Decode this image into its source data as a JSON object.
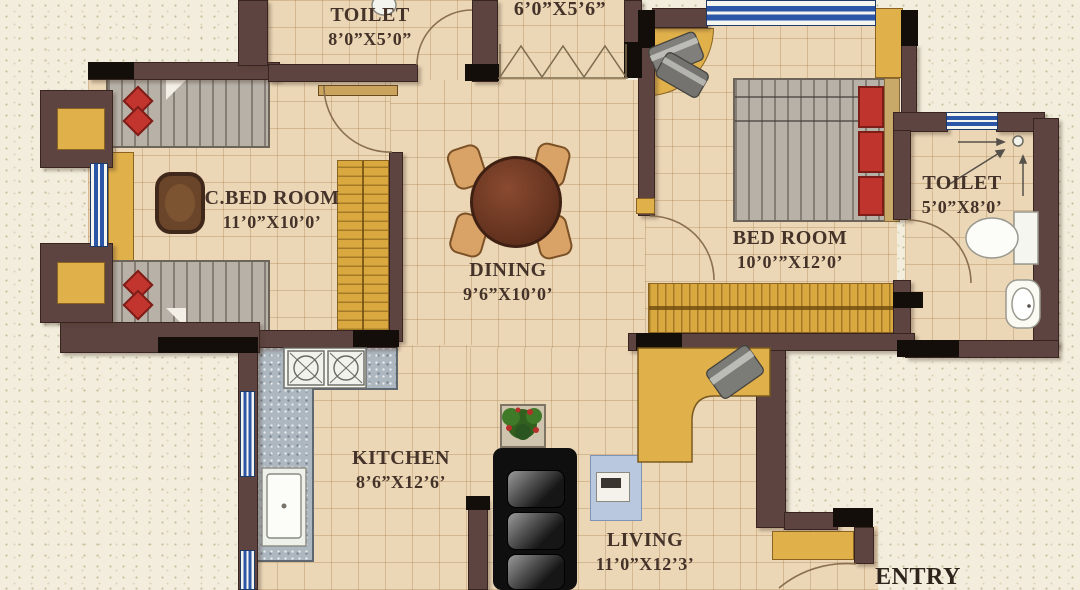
{
  "rooms": {
    "toilet_top": {
      "name": "TOILET",
      "dims": "8’0”X5’0”"
    },
    "dress": {
      "dims": "6’0”X5’6”"
    },
    "c_bed_room": {
      "name": "C.BED ROOM",
      "dims": "11’0”X10’0’"
    },
    "dining": {
      "name": "DINING",
      "dims": "9’6”X10’0’"
    },
    "bed_room": {
      "name": "BED ROOM",
      "dims": "10’0’”X12’0’"
    },
    "toilet_right": {
      "name": "TOILET",
      "dims": "5’0”X8’0’"
    },
    "kitchen": {
      "name": "KITCHEN",
      "dims": "8’6”X12’6’"
    },
    "living": {
      "name": "LIVING",
      "dims": "11’0”X12’3’"
    },
    "entry": {
      "name": "ENTRY"
    }
  },
  "colors": {
    "outside": "#f2eddc",
    "floor_tile": "#ebd7b6",
    "wall": "#5e4440",
    "wall_end_black": "#140e0b",
    "window_blue": "#2c57a7",
    "wood_yellow": "#d9a83f",
    "bed_gray": "#b7b1a8",
    "pillow_red": "#c2342e",
    "sofa_black": "#141414",
    "counter_gray": "#adb7c0",
    "table_brown": "#6a3420"
  }
}
